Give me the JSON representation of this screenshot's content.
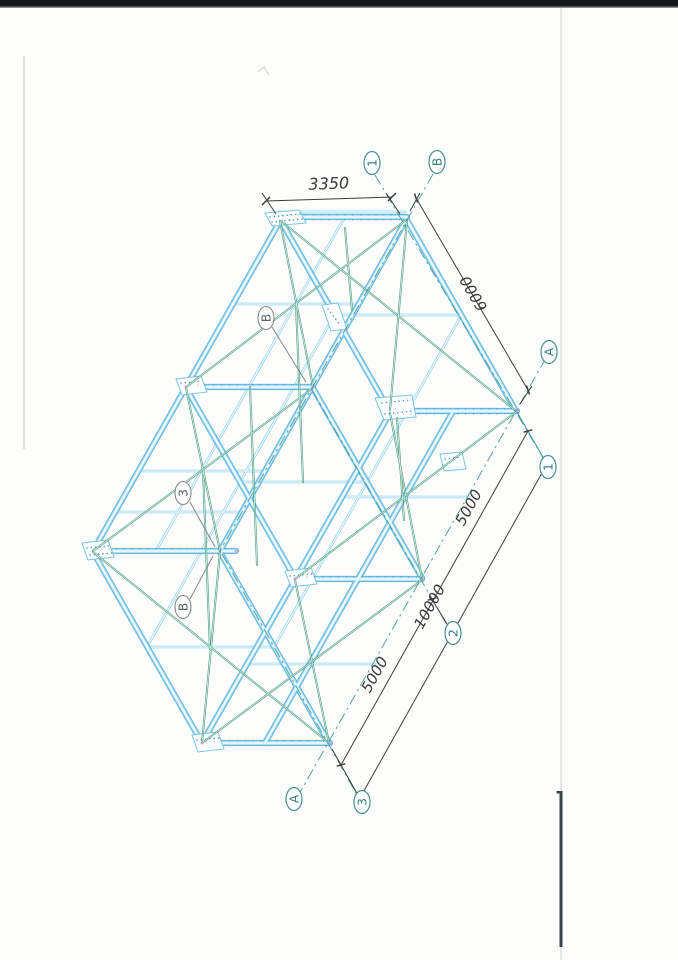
{
  "dims": {
    "top": "3350",
    "height": "6000",
    "bay_upper": "5000",
    "overall": "10000",
    "bay_lower": "5000"
  },
  "bubbles": {
    "top_1": "1",
    "top_b": "B",
    "right_a": "A",
    "right_1": "1",
    "mid_2": "2",
    "bottom_a": "A",
    "bottom_3": "3",
    "internal_b_upper": "B",
    "internal_3": "3",
    "internal_b_lower": "B"
  },
  "colors": {
    "beam": "#5cb5e0",
    "brace": "#31906c",
    "axis": "#3f9a97",
    "dimension": "#3c3c3c",
    "scan_bar": "#16191b"
  }
}
